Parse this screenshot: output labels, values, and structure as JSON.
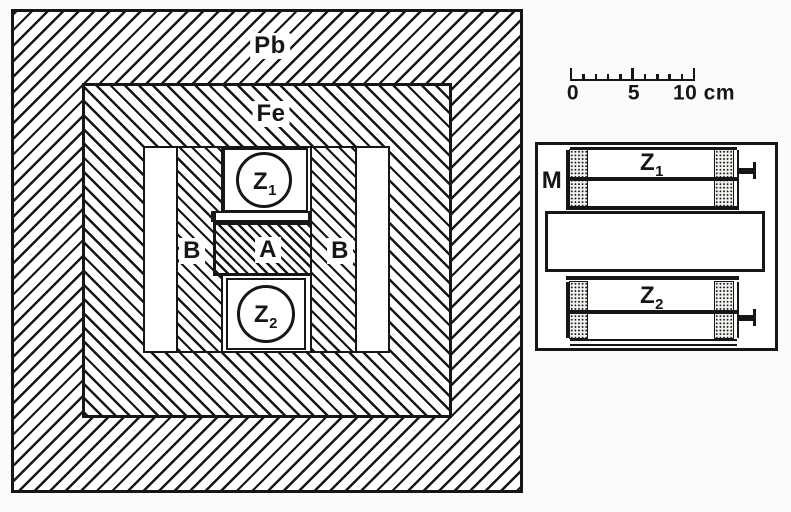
{
  "cross_section": {
    "pb_label": "Pb",
    "fe_label": "Fe",
    "b_left_label": "B",
    "a_label": "A",
    "b_right_label": "B",
    "z1_label": {
      "base": "Z",
      "sub": "1"
    },
    "z2_label": {
      "base": "Z",
      "sub": "2"
    }
  },
  "scale_bar": {
    "start_label": "0",
    "mid_label": "5",
    "end_label": "10 cm",
    "ticks_cm": [
      0,
      1,
      2,
      3,
      4,
      5,
      6,
      7,
      8,
      9,
      10
    ],
    "major_ticks_cm": [
      0,
      5,
      10
    ],
    "length_cm": 10
  },
  "side_view": {
    "m_label": "M",
    "z1_label": {
      "base": "Z",
      "sub": "1"
    },
    "z2_label": {
      "base": "Z",
      "sub": "2"
    }
  },
  "colors": {
    "ink": "#161616",
    "paper": "#fbfbfa"
  }
}
